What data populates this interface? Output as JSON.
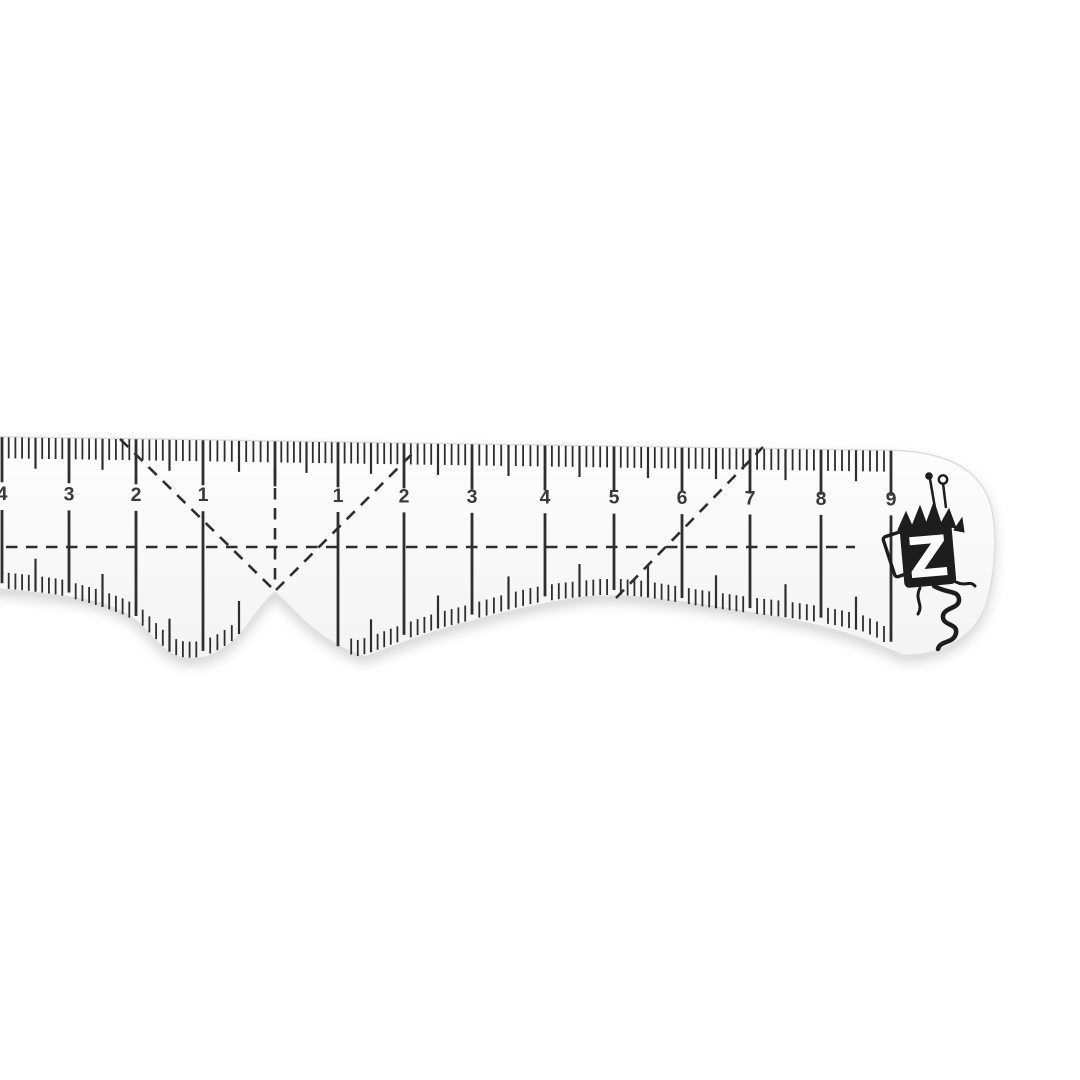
{
  "meta": {
    "description": "Product photo of a transparent sewing curve ruler (hip/armhole curve) with centimeter scale and Z monogram brand logo, on a white background"
  },
  "colors": {
    "background": "#ffffff",
    "ruler_fill_top": "#fdfdfd",
    "ruler_fill_bottom": "#f5f4f4",
    "edge": "#dddcdc",
    "ink": "#2e2e2e",
    "number_ink": "#3a3a3a",
    "shadow": "#000000",
    "shadow_opacity": "0.16",
    "logo_fill": "#1d1d1d",
    "logo_letter_color": "#ffffff"
  },
  "ruler": {
    "outline_path": "M -14,436.5 L 897,450.5 C 946,452.5 981,469 991,506 C 997,530 996,567 988,598 C 980,630 951,656 903,655.5 C 878,644 846,631 800,621.5 C 755,613 705,604 656,599 C 634,596.5 614,595.5 599,596.2 C 563,598.5 520,608 471,621.5 C 433,631 398,644 366,657 C 343,651 322,637 303,620 Q 284,601 275,592 Q 265,601 252,619 C 238,640 224,651 206,657 Q 191,661 176,656 C 162,650 152,636 139,623 C 121,608 96,600 60,595.8 C 35,592.5 10,590 -14,588.2 Z",
    "top_edge": {
      "x0": -14,
      "y0": 436.5,
      "slope": 0.0152
    },
    "bottom_profile": [
      [
        -14,
        588
      ],
      [
        0,
        589
      ],
      [
        30,
        592
      ],
      [
        60,
        596
      ],
      [
        100,
        607
      ],
      [
        122,
        615
      ],
      [
        140,
        624
      ],
      [
        155,
        639
      ],
      [
        168,
        652
      ],
      [
        180,
        658
      ],
      [
        194,
        659
      ],
      [
        207,
        656
      ],
      [
        220,
        650
      ],
      [
        232,
        642
      ],
      [
        244,
        630
      ],
      [
        256,
        615
      ],
      [
        266,
        602
      ],
      [
        275,
        592
      ],
      [
        284,
        602
      ],
      [
        294,
        617
      ],
      [
        306,
        632
      ],
      [
        318,
        643
      ],
      [
        330,
        650
      ],
      [
        344,
        654
      ],
      [
        358,
        657
      ],
      [
        372,
        653
      ],
      [
        390,
        646
      ],
      [
        412,
        638
      ],
      [
        436,
        630
      ],
      [
        460,
        624
      ],
      [
        485,
        617
      ],
      [
        510,
        610
      ],
      [
        535,
        604
      ],
      [
        560,
        600
      ],
      [
        580,
        598
      ],
      [
        600,
        596
      ],
      [
        622,
        596
      ],
      [
        645,
        598
      ],
      [
        670,
        602
      ],
      [
        700,
        607
      ],
      [
        728,
        611
      ],
      [
        756,
        615
      ],
      [
        784,
        618
      ],
      [
        812,
        622
      ],
      [
        840,
        627
      ],
      [
        862,
        632
      ],
      [
        878,
        639
      ],
      [
        890,
        647
      ],
      [
        900,
        655
      ]
    ],
    "scale": {
      "cm_x": [
        2,
        69,
        136,
        203,
        275,
        338,
        404,
        472,
        545,
        614,
        682,
        750,
        821,
        891
      ],
      "center_index": 4,
      "numbers": [
        {
          "label": "4",
          "x": 2
        },
        {
          "label": "3",
          "x": 69
        },
        {
          "label": "2",
          "x": 136
        },
        {
          "label": "1",
          "x": 203
        },
        {
          "label": "1",
          "x": 338
        },
        {
          "label": "2",
          "x": 404
        },
        {
          "label": "3",
          "x": 472
        },
        {
          "label": "4",
          "x": 545
        },
        {
          "label": "5",
          "x": 614
        },
        {
          "label": "6",
          "x": 682
        },
        {
          "label": "7",
          "x": 750
        },
        {
          "label": "8",
          "x": 821
        },
        {
          "label": "9",
          "x": 891
        }
      ],
      "number_font_size": 19.5,
      "number_y_base": 494,
      "number_y_slope": 0.006,
      "top_tick_len": {
        "mm": 21,
        "half": 31,
        "cm": 45
      },
      "top_tick_w": {
        "mm": 1.8,
        "half": 2.2,
        "cm": 2.8
      },
      "bottom_tick_len": {
        "mm": 16,
        "half": 33
      },
      "bottom_tick_w": {
        "mm": 1.8,
        "half": 2.2
      },
      "bottom_skip": [
        246,
        346
      ],
      "bottom_range": [
        0,
        898
      ],
      "unit_line_w": 2.8,
      "unit_line_top_offset": 16,
      "unit_line_bottom_gap": 6
    },
    "guides": {
      "dash_pattern": "11.5 8.5",
      "stroke_w": 2.6,
      "lines": [
        {
          "name": "horizontal-guide-line",
          "x1": -14,
          "y1": 547,
          "x2": 855,
          "y2": 547
        },
        {
          "name": "center-vertical-guide-line",
          "x1": 275,
          "y1": 468,
          "x2": 275,
          "y2": 588
        },
        {
          "name": "left-v-guide-line",
          "x1": 120,
          "y1": 439,
          "x2": 274,
          "y2": 590
        },
        {
          "name": "right-v-guide-line",
          "x1": 276,
          "y1": 590,
          "x2": 418,
          "y2": 448
        },
        {
          "name": "hip-diagonal-guide-line",
          "x1": 616,
          "y1": 598,
          "x2": 763,
          "y2": 447
        }
      ]
    },
    "logo": {
      "letter": "Z",
      "cx": 928,
      "cy": 556,
      "rotation": -5,
      "letter_font_size": 56
    }
  }
}
